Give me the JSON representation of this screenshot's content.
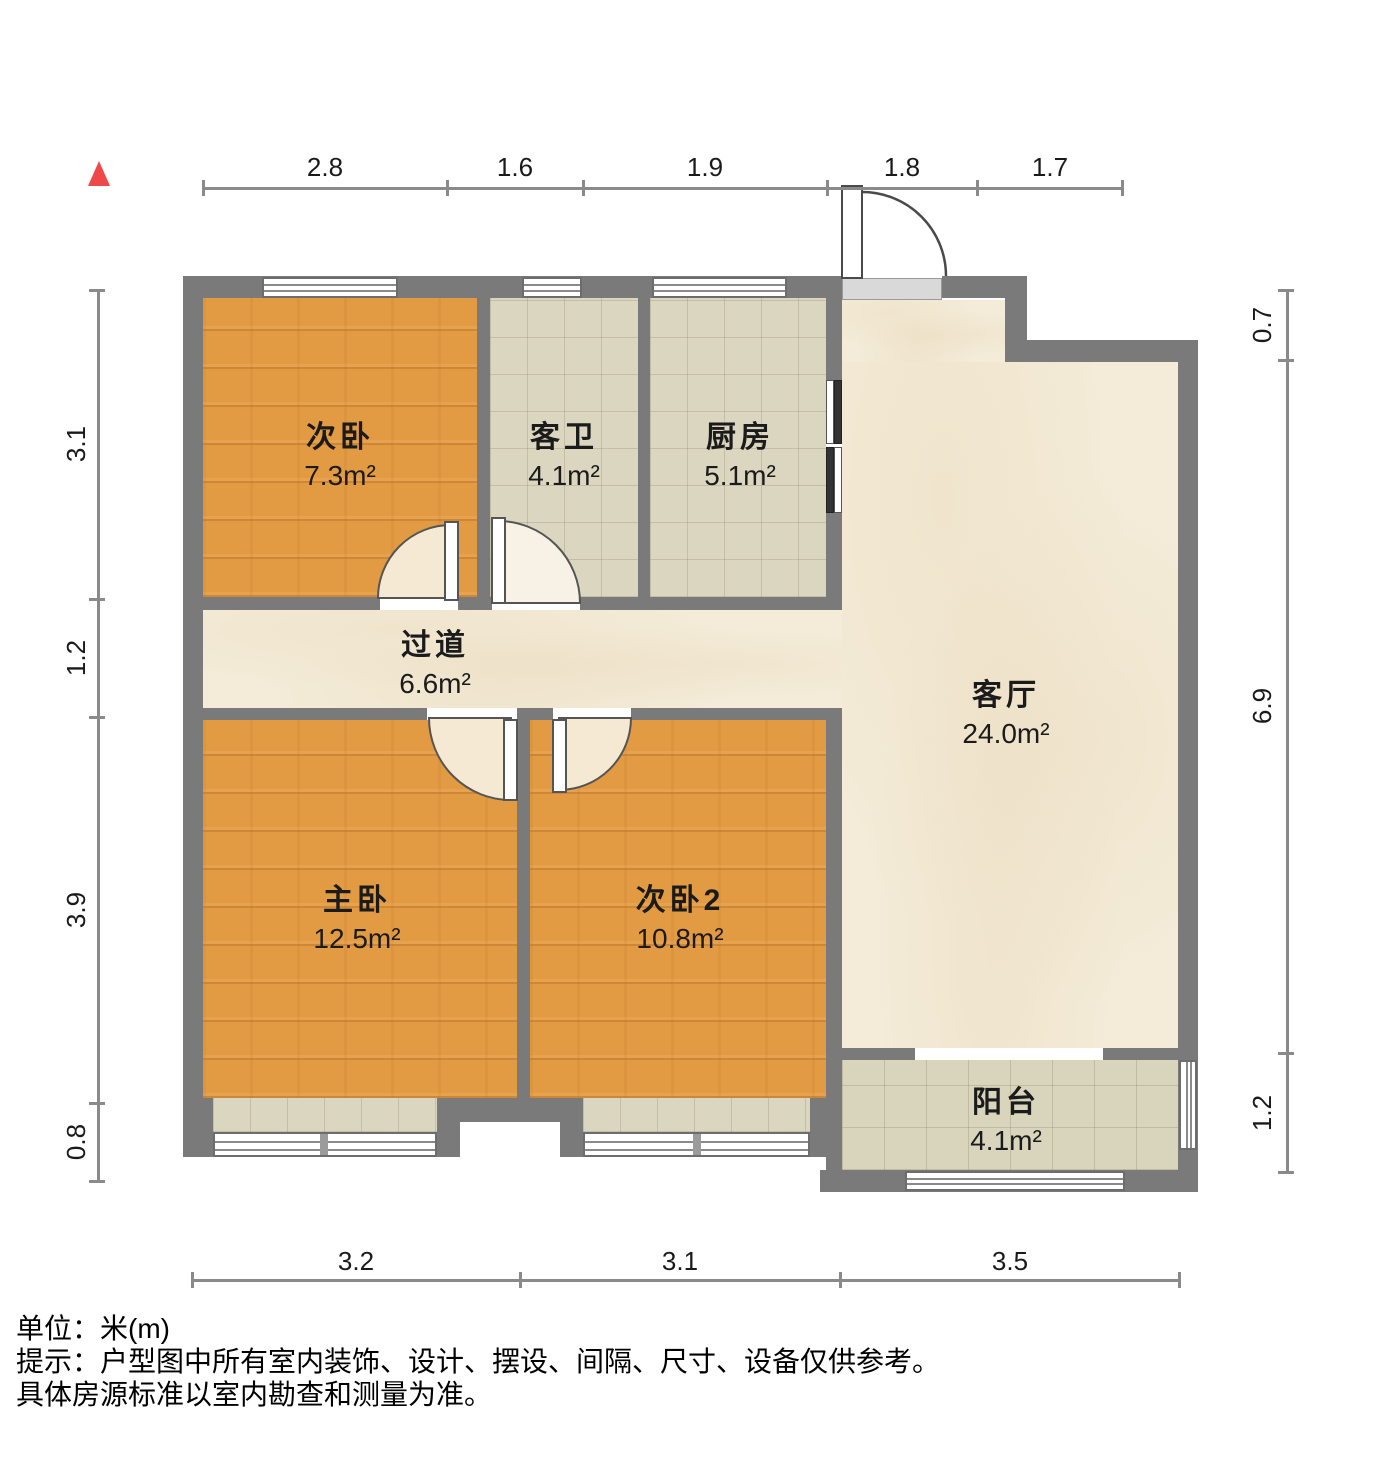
{
  "title": "户型图",
  "rooms": [
    {
      "name": "次卧",
      "area": "7.3m²"
    },
    {
      "name": "客卫",
      "area": "4.1m²"
    },
    {
      "name": "厨房",
      "area": "5.1m²"
    },
    {
      "name": "过道",
      "area": "6.6m²"
    },
    {
      "name": "客厅",
      "area": "24.0m²"
    },
    {
      "name": "主卧",
      "area": "12.5m²"
    },
    {
      "name": "次卧2",
      "area": "10.8m²"
    },
    {
      "name": "阳台",
      "area": "4.1m²"
    }
  ],
  "dims": {
    "top": [
      "2.8",
      "1.6",
      "1.9",
      "1.8",
      "1.7"
    ],
    "left": [
      "3.1",
      "1.2",
      "3.9",
      "0.8"
    ],
    "right": [
      "0.7",
      "6.9",
      "1.2"
    ],
    "bottom": [
      "3.2",
      "3.1",
      "3.5"
    ]
  },
  "footer": {
    "line1": "单位：米(m)",
    "line2": "提示：户型图中所有室内装饰、设计、摆设、间隔、尺寸、设备仅供参考。",
    "line3": "具体房源标准以室内勘查和测量为准。"
  },
  "colors": {
    "wall": "#7a7a7a",
    "wood_floor": "#e29a43",
    "tile_floor": "#dbd6bf",
    "marble_floor": "#f4ecd9",
    "balcony_floor": "#d8d5bc",
    "north_arrow": "#ef4848",
    "dimension_line": "#8a8a8a"
  }
}
